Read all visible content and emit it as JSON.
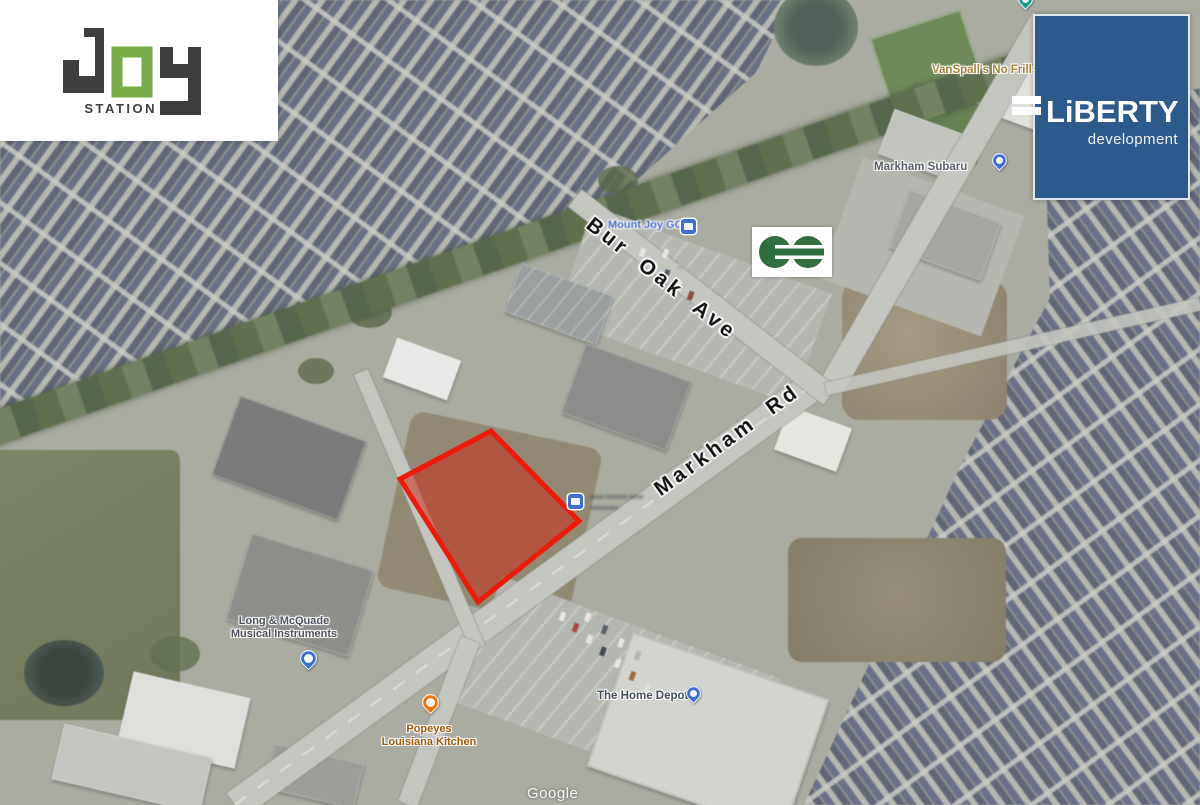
{
  "branding": {
    "joy_station": {
      "word": "JOY",
      "sub": "STATION"
    },
    "liberty": {
      "name": "LiBERTY",
      "sub": "development"
    }
  },
  "map": {
    "streets": {
      "bur_oak": "Bur Oak Ave",
      "markham": "Markham Rd"
    },
    "poi": {
      "mount_joy_go": "Mount Joy GO",
      "no_frills": "VanSpall's No Frills",
      "markham_subaru": "Markham Subaru",
      "long_mcquade_line1": "Long & McQuade",
      "long_mcquade_line2": "Musical Instruments",
      "popeyes_line1": "Popeyes",
      "popeyes_line2": "Louisiana Kitchen",
      "home_depot": "The Home Depot",
      "illegible_line1": "▬▬ ▬▬▬ ▬▬",
      "illegible_line2": "▬▬▬▬"
    },
    "watermark": "Google"
  },
  "icons": {
    "go_transit_logo": "GO Transit",
    "blue_place_pin": "place-pin",
    "orange_food_pin": "restaurant-pin",
    "teal_park_pin": "park-pin",
    "blue_square_poi": "transit-station-square"
  },
  "colors": {
    "site_outline": "#ee1b0c",
    "site_fill": "rgba(201,44,28,0.55)",
    "liberty_blue": "#2b5a8b",
    "joy_green": "#77ae47",
    "go_green": "#2f6f3e"
  }
}
